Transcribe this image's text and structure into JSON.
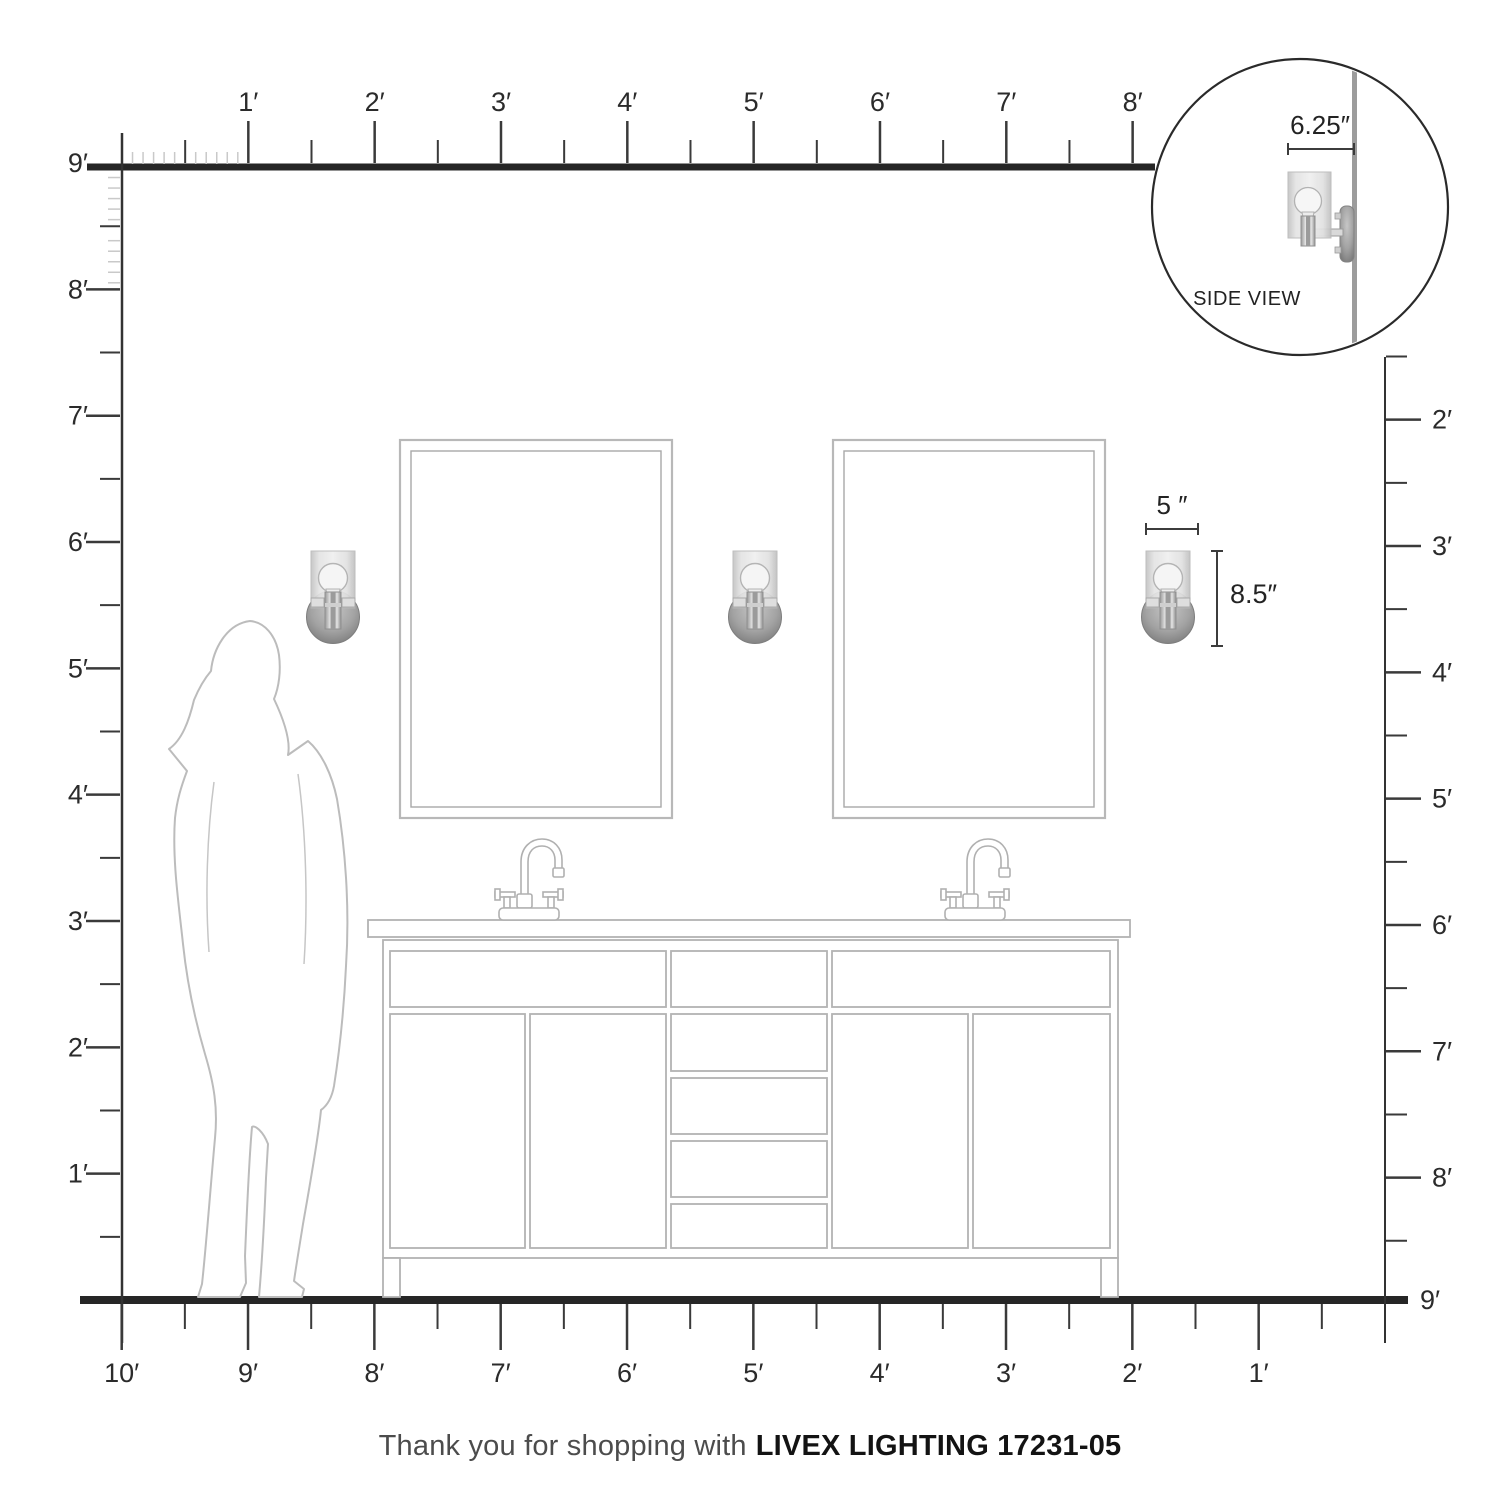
{
  "footer": {
    "prefix": "Thank you for shopping with",
    "brand_model": "LIVEX LIGHTING 17231-05"
  },
  "inset": {
    "label": "SIDE VIEW",
    "depth_dim": "6.25″"
  },
  "sconce_dims": {
    "width": "5 ″",
    "height": "8.5″"
  },
  "rulers": {
    "top": {
      "unit": "feet",
      "labels": [
        "1′",
        "2′",
        "3′",
        "4′",
        "5′",
        "6′",
        "7′",
        "8′"
      ]
    },
    "left": {
      "unit": "feet",
      "labels": [
        "9′",
        "8′",
        "7′",
        "6′",
        "5′",
        "4′",
        "3′",
        "2′",
        "1′"
      ]
    },
    "right": {
      "unit": "feet",
      "labels": [
        "2′",
        "3′",
        "4′",
        "5′",
        "6′",
        "7′",
        "8′",
        "9′"
      ]
    },
    "bottom": {
      "unit": "feet",
      "labels": [
        "10′",
        "9′",
        "8′",
        "7′",
        "6′",
        "5′",
        "4′",
        "3′",
        "2′",
        "1′"
      ]
    }
  },
  "colors": {
    "ruler_line": "#262626",
    "tick": "#3a3a3a",
    "inch_tick": "#c9c9c9",
    "label": "#2b2b2b",
    "line_art": "#b3b3b3",
    "dimension": "#3c3c3c"
  }
}
